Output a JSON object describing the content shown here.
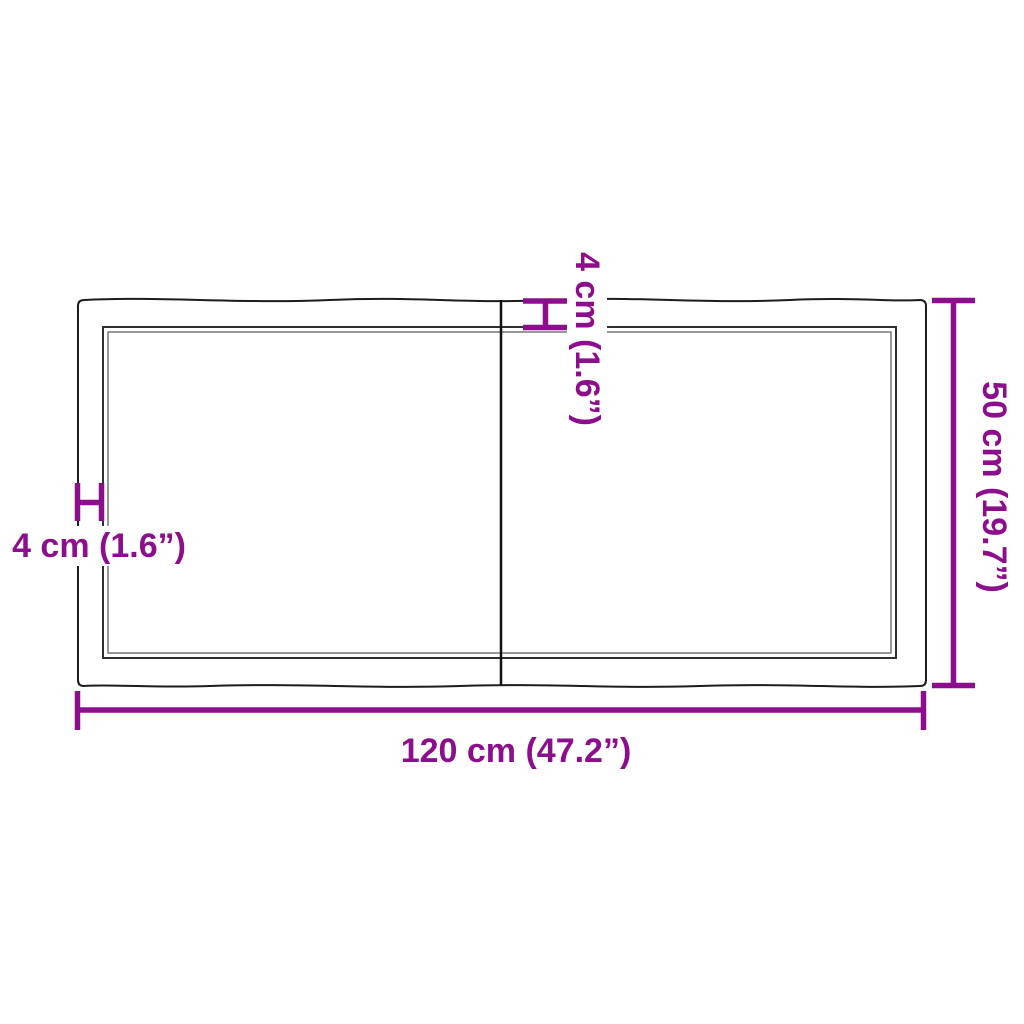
{
  "diagram": {
    "kind": "tabletop-top-view-dimension-diagram",
    "dimensions": {
      "width_label": "120 cm (47.2”)",
      "height_label": "50 cm (19.7”)",
      "top_thickness_label": "4 cm (1.6”)",
      "left_thickness_label": "4 cm (1.6”)"
    },
    "colors": {
      "dimension_accent": "#8d0e8c",
      "outline": "#1d1d1d",
      "inner_edge_dark": "#2f2f2f",
      "inner_edge_light": "#777777",
      "background": "#ffffff"
    }
  }
}
